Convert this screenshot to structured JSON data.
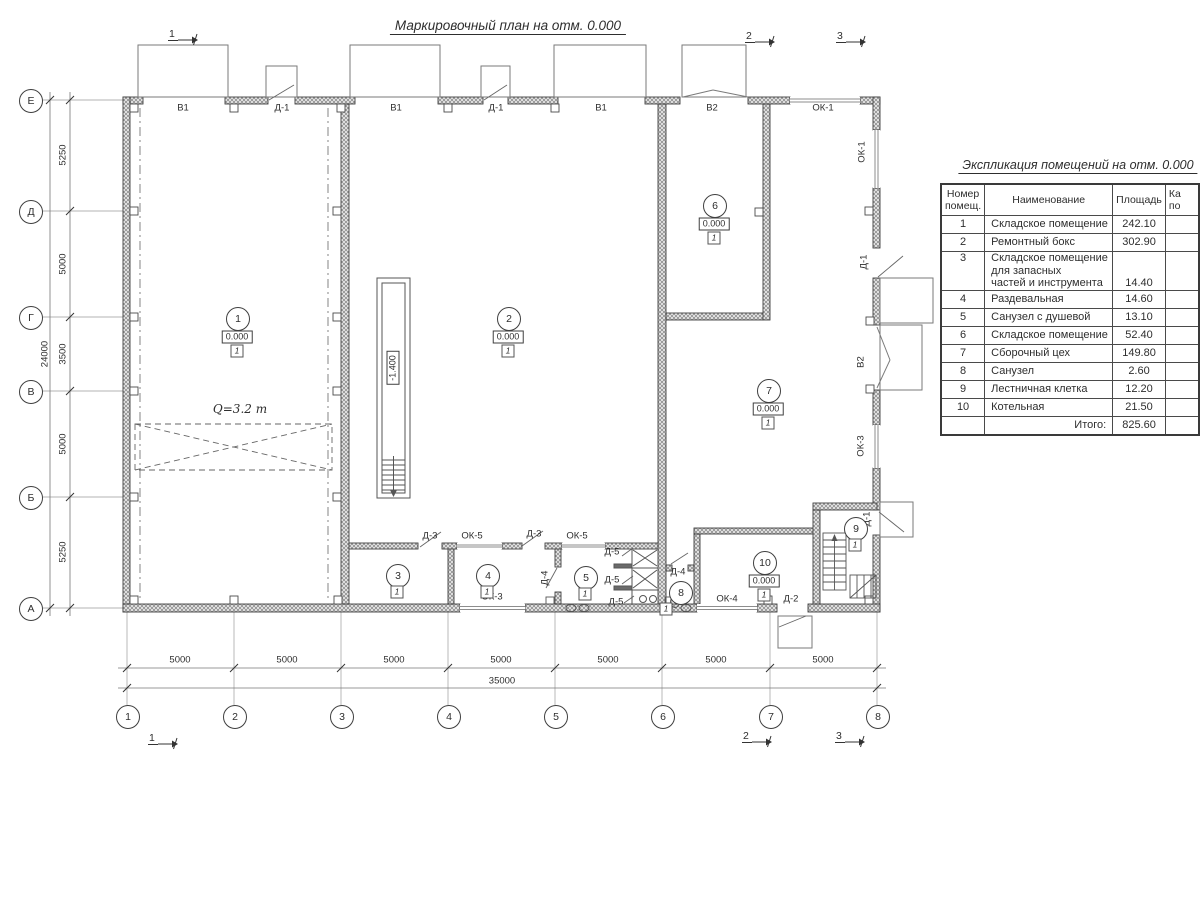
{
  "plan": {
    "title": "Маркировочный план на отм. 0.000",
    "crane_label": "Q=3.2 т",
    "pit_label": "-1.400",
    "labels": [
      {
        "t": "В1",
        "x": 183,
        "y": 108
      },
      {
        "t": "Д-1",
        "x": 282,
        "y": 108
      },
      {
        "t": "В1",
        "x": 396,
        "y": 108
      },
      {
        "t": "Д-1",
        "x": 496,
        "y": 108
      },
      {
        "t": "В1",
        "x": 601,
        "y": 108
      },
      {
        "t": "В2",
        "x": 712,
        "y": 108
      },
      {
        "t": "ОК-1",
        "x": 823,
        "y": 108
      },
      {
        "t": "ОК-1",
        "x": 862,
        "y": 152,
        "r": 1
      },
      {
        "t": "Д-1",
        "x": 864,
        "y": 262,
        "r": 1
      },
      {
        "t": "В2",
        "x": 861,
        "y": 362,
        "r": 1
      },
      {
        "t": "ОК-3",
        "x": 861,
        "y": 446,
        "r": 1
      },
      {
        "t": "Д-1",
        "x": 867,
        "y": 519,
        "r": 1
      },
      {
        "t": "ОК-3",
        "x": 492,
        "y": 597
      },
      {
        "t": "ОК-4",
        "x": 727,
        "y": 599
      },
      {
        "t": "Д-2",
        "x": 791,
        "y": 599
      },
      {
        "t": "Д-3",
        "x": 430,
        "y": 536
      },
      {
        "t": "ОК-5",
        "x": 472,
        "y": 536
      },
      {
        "t": "Д-3",
        "x": 534,
        "y": 534
      },
      {
        "t": "ОК-5",
        "x": 577,
        "y": 536
      },
      {
        "t": "Д-4",
        "x": 545,
        "y": 578,
        "r": 1
      },
      {
        "t": "Д-4",
        "x": 678,
        "y": 572
      },
      {
        "t": "Д-5",
        "x": 612,
        "y": 552
      },
      {
        "t": "Д-5",
        "x": 612,
        "y": 580
      },
      {
        "t": "Д-5",
        "x": 616,
        "y": 602
      }
    ],
    "rooms": [
      {
        "n": "1",
        "x": 237,
        "y": 318,
        "e": "0.000",
        "f": "1"
      },
      {
        "n": "2",
        "x": 508,
        "y": 318,
        "e": "0.000",
        "f": "1"
      },
      {
        "n": "3",
        "x": 397,
        "y": 575,
        "f": "1"
      },
      {
        "n": "4",
        "x": 487,
        "y": 575,
        "f": "1"
      },
      {
        "n": "5",
        "x": 585,
        "y": 577,
        "f": "1"
      },
      {
        "n": "6",
        "x": 714,
        "y": 205,
        "e": "0.000",
        "f": "1"
      },
      {
        "n": "7",
        "x": 768,
        "y": 390,
        "e": "0.000",
        "f": "1"
      },
      {
        "n": "8",
        "x": 680,
        "y": 592,
        "f": "1",
        "fleft": true
      },
      {
        "n": "9",
        "x": 855,
        "y": 528,
        "f": "1"
      },
      {
        "n": "10",
        "x": 764,
        "y": 562,
        "e": "0.000",
        "f": "1"
      }
    ],
    "sections": [
      {
        "t": "1",
        "x": 168,
        "y": 28
      },
      {
        "t": "2",
        "x": 745,
        "y": 30
      },
      {
        "t": "3",
        "x": 836,
        "y": 30
      },
      {
        "t": "1",
        "x": 148,
        "y": 732
      },
      {
        "t": "2",
        "x": 742,
        "y": 730
      },
      {
        "t": "3",
        "x": 835,
        "y": 730
      }
    ]
  },
  "axes": {
    "cols": [
      {
        "t": "1",
        "x": 127
      },
      {
        "t": "2",
        "x": 234
      },
      {
        "t": "3",
        "x": 341
      },
      {
        "t": "4",
        "x": 448
      },
      {
        "t": "5",
        "x": 555
      },
      {
        "t": "6",
        "x": 662
      },
      {
        "t": "7",
        "x": 770
      },
      {
        "t": "8",
        "x": 877
      }
    ],
    "rows": [
      {
        "t": "Е",
        "y": 100
      },
      {
        "t": "Д",
        "y": 211
      },
      {
        "t": "Г",
        "y": 317
      },
      {
        "t": "В",
        "y": 391
      },
      {
        "t": "Б",
        "y": 497
      },
      {
        "t": "А",
        "y": 608
      }
    ]
  },
  "dims": {
    "bottom": [
      {
        "t": "5000",
        "x": 180
      },
      {
        "t": "5000",
        "x": 287
      },
      {
        "t": "5000",
        "x": 394
      },
      {
        "t": "5000",
        "x": 501
      },
      {
        "t": "5000",
        "x": 608
      },
      {
        "t": "5000",
        "x": 716
      },
      {
        "t": "5000",
        "x": 823
      }
    ],
    "bottom_total": {
      "t": "35000",
      "x": 502
    },
    "left": [
      {
        "t": "5250",
        "y": 155
      },
      {
        "t": "5000",
        "y": 264
      },
      {
        "t": "3500",
        "y": 354
      },
      {
        "t": "5000",
        "y": 444
      },
      {
        "t": "5250",
        "y": 552
      }
    ],
    "left_total": {
      "t": "24000",
      "y": 354
    }
  },
  "table": {
    "title": "Экспликация помещений на отм. 0.000",
    "headers": {
      "num": [
        "Номер",
        "помещ."
      ],
      "name": "Наименование",
      "area": "Площадь",
      "cat": [
        "Ка",
        "по"
      ]
    },
    "rows": [
      {
        "num": "1",
        "name": "Складское помещение",
        "area": "242.10"
      },
      {
        "num": "2",
        "name": "Ремонтный бокс",
        "area": "302.90"
      },
      {
        "num": "3",
        "name": "Складское помещение для запасных\nчастей и инструмента",
        "area": "14.40",
        "tall": true
      },
      {
        "num": "4",
        "name": "Раздевальная",
        "area": "14.60"
      },
      {
        "num": "5",
        "name": "Санузел с душевой",
        "area": "13.10"
      },
      {
        "num": "6",
        "name": "Складское помещение",
        "area": "52.40"
      },
      {
        "num": "7",
        "name": "Сборочный цех",
        "area": "149.80"
      },
      {
        "num": "8",
        "name": "Санузел",
        "area": "2.60"
      },
      {
        "num": "9",
        "name": "Лестничная клетка",
        "area": "12.20"
      },
      {
        "num": "10",
        "name": "Котельная",
        "area": "21.50"
      }
    ],
    "total": {
      "label": "Итого:",
      "value": "825.60"
    }
  }
}
